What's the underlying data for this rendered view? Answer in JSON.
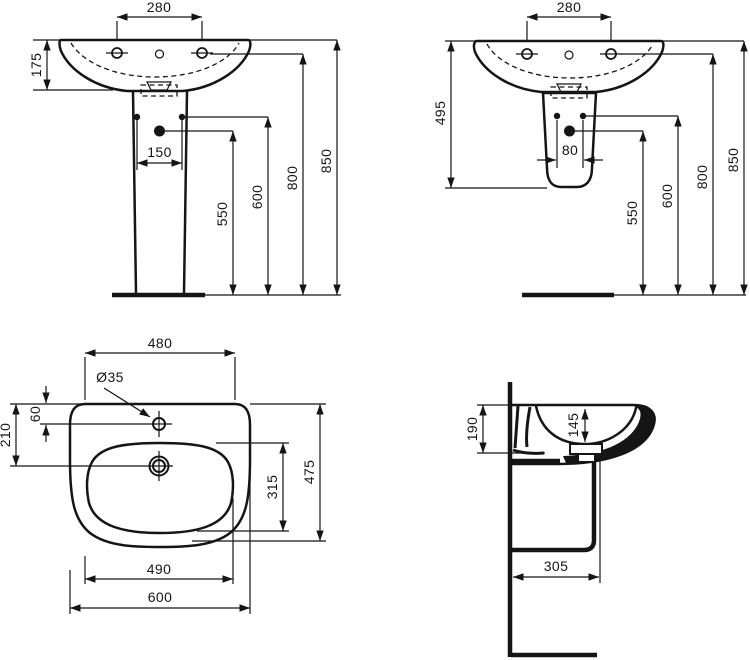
{
  "drawing": {
    "views": {
      "front_pedestal": {
        "d280": "280",
        "d175": "175",
        "d150": "150",
        "d550": "550",
        "d600": "600",
        "d800": "800",
        "d850": "850"
      },
      "front_semi": {
        "d280": "280",
        "d495": "495",
        "d80": "80",
        "d550": "550",
        "d600": "600",
        "d800": "800",
        "d850": "850"
      },
      "plan": {
        "d480": "480",
        "hole": "Ø35",
        "d60": "60",
        "d210": "210",
        "d315": "315",
        "d475": "475",
        "d490": "490",
        "d600": "600"
      },
      "side": {
        "d190": "190",
        "d145": "145",
        "d305": "305"
      }
    }
  }
}
